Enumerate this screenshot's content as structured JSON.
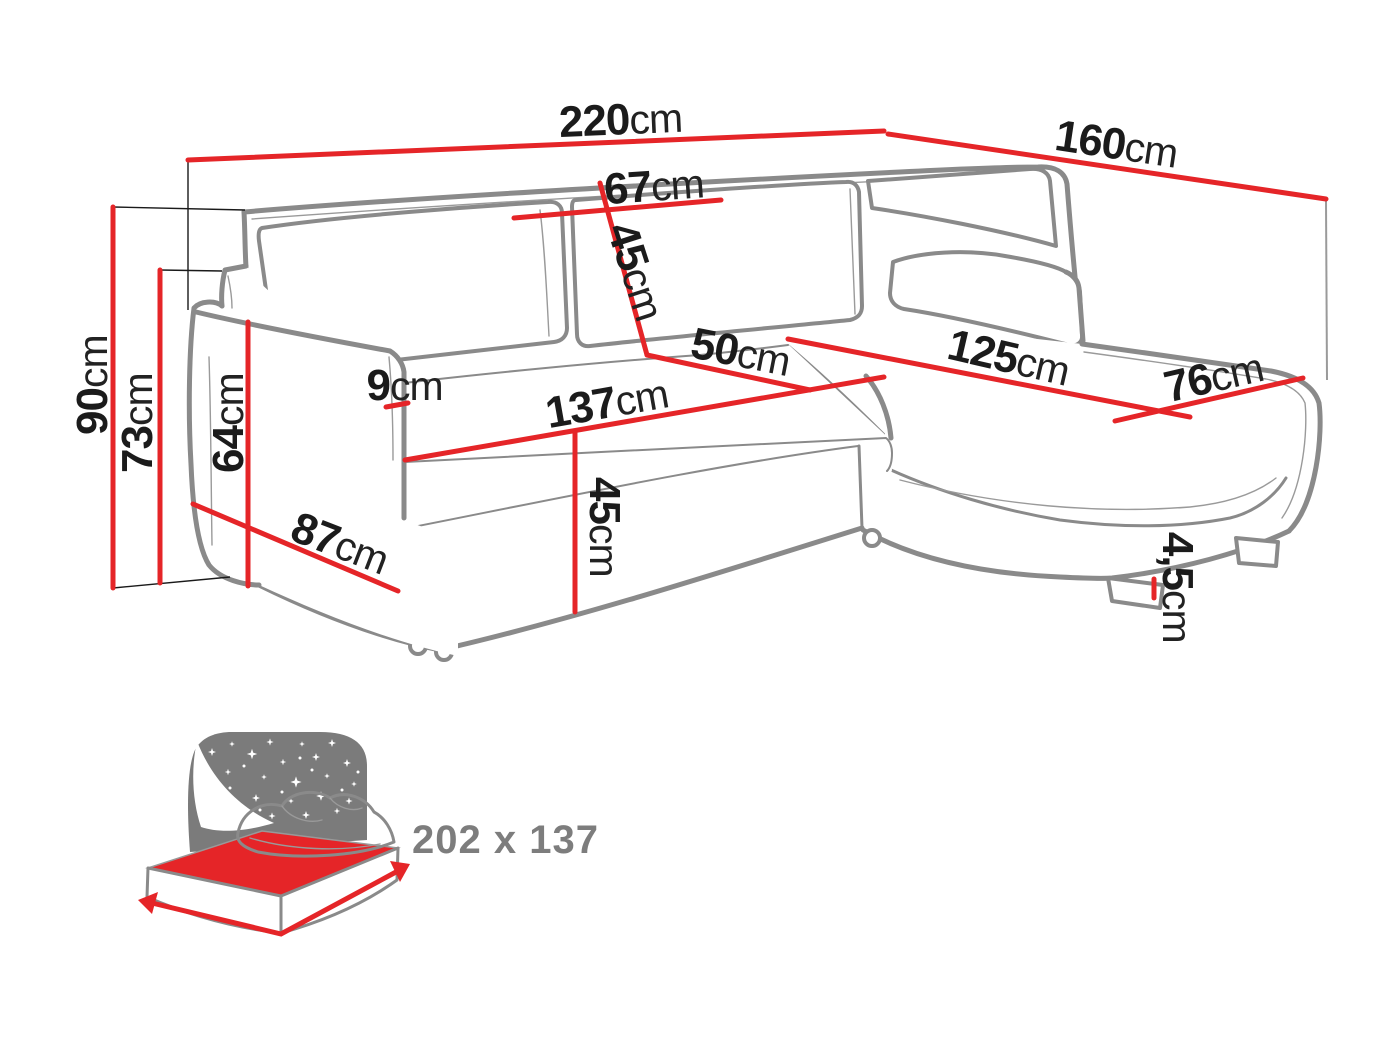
{
  "diagram": {
    "type": "sofa-dimension-drawing",
    "units": "cm",
    "colors": {
      "dimension_red": "#e52528",
      "outline_gray": "#8a8a8a",
      "text_black": "#1b1b1b",
      "icon_gray": "#7b7b7b"
    }
  },
  "dimensions": {
    "back_width": {
      "value": "220",
      "unit": "cm"
    },
    "side_depth_right": {
      "value": "160",
      "unit": "cm"
    },
    "total_height": {
      "value": "90",
      "unit": "cm"
    },
    "armrest_height": {
      "value": "73",
      "unit": "cm"
    },
    "arm_front_height": {
      "value": "64",
      "unit": "cm"
    },
    "arm_width": {
      "value": "9",
      "unit": "cm"
    },
    "cushion_width": {
      "value": "67",
      "unit": "cm"
    },
    "cushion_height": {
      "value": "45",
      "unit": "cm"
    },
    "seat_depth": {
      "value": "50",
      "unit": "cm"
    },
    "seat_width": {
      "value": "137",
      "unit": "cm"
    },
    "seat_height": {
      "value": "45",
      "unit": "cm"
    },
    "side_depth_left": {
      "value": "87",
      "unit": "cm"
    },
    "chaise_length": {
      "value": "125",
      "unit": "cm"
    },
    "chaise_width": {
      "value": "76",
      "unit": "cm"
    },
    "leg_height": {
      "value": "4,5",
      "unit": "cm"
    }
  },
  "sleeping_area": {
    "label": "202 x 137"
  }
}
